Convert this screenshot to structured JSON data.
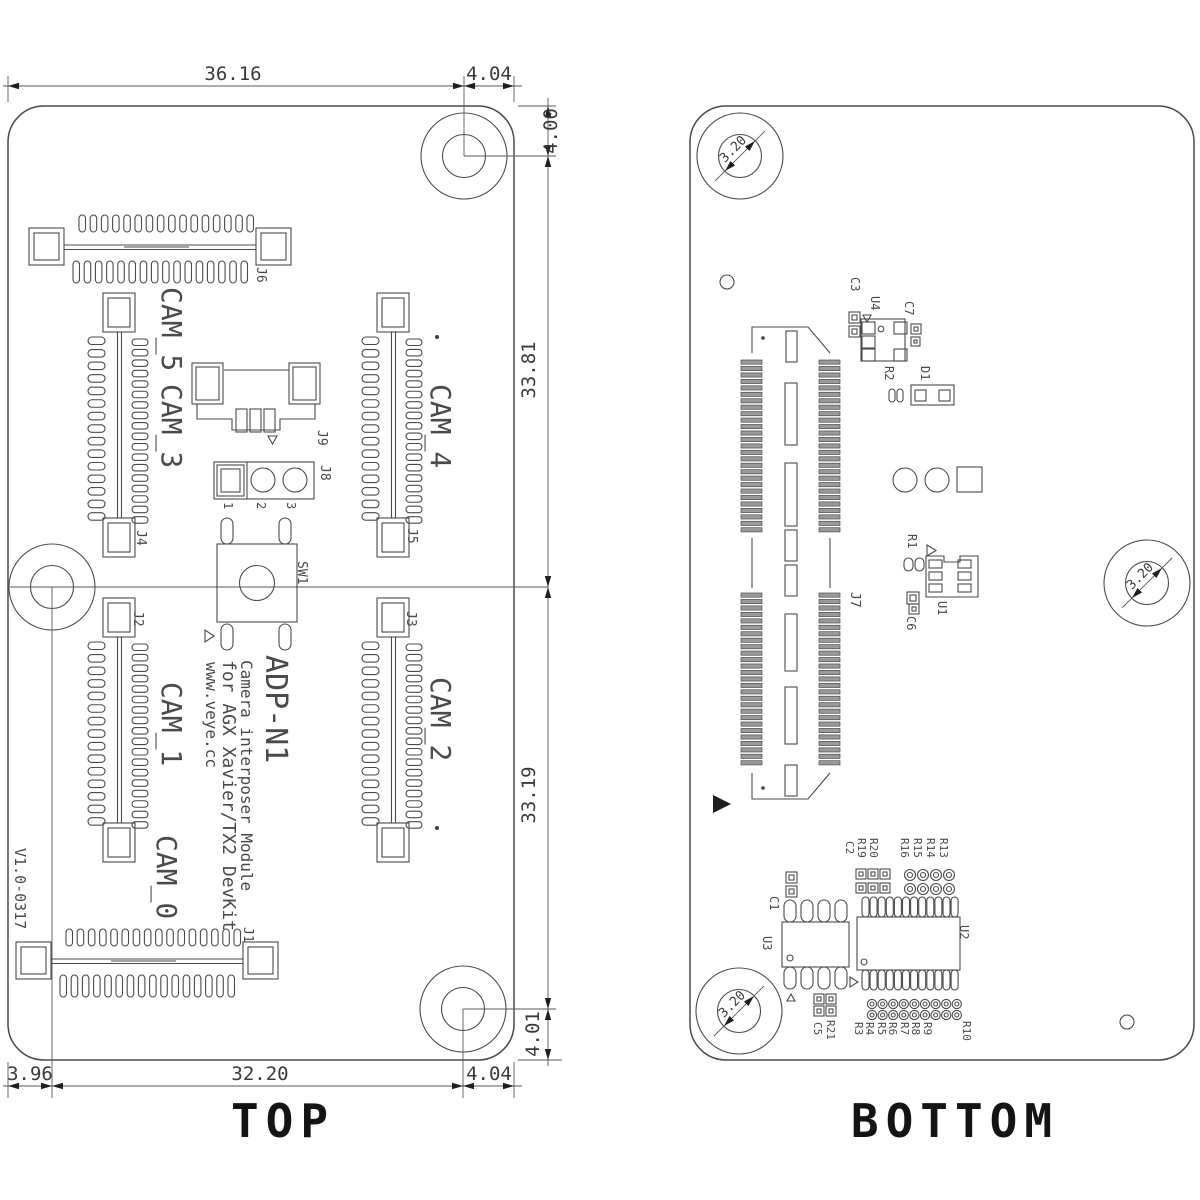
{
  "drawing": {
    "top_view": {
      "title": "TOP",
      "version": "V1.0-0317",
      "silkscreen": {
        "model": "ADP-N1",
        "line1": "Camera interposer Module",
        "line2": "for AGX Xavier/TX2 DevKit",
        "line3": "www.veye.cc"
      },
      "cams": {
        "cam0": "CAM_0",
        "cam1": "CAM_1",
        "cam2": "CAM_2",
        "cam3": "CAM_3",
        "cam4": "CAM_4",
        "cam5": "CAM_5"
      },
      "refs": {
        "j1": "J1",
        "j2": "J2",
        "j3": "J3",
        "j4": "J4",
        "j5": "J5",
        "j6": "J6",
        "j8": "J8",
        "j9": "J9",
        "sw1": "SW1"
      },
      "jumper_pins": [
        "1",
        "2",
        "3"
      ],
      "dims": {
        "top_main": "36.16",
        "top_offset": "4.04",
        "right_top": "4.00",
        "right_upper": "33.81",
        "right_lower": "33.19",
        "right_bottom": "4.01",
        "bottom_left": "3.96",
        "bottom_main": "32.20",
        "bottom_offset": "4.04"
      }
    },
    "bottom_view": {
      "title": "BOTTOM",
      "hole_diameter": "3.20",
      "refs": {
        "j7": "J7",
        "u1": "U1",
        "u2": "U2",
        "u3": "U3",
        "u4": "U4",
        "d1": "D1",
        "r1": "R1",
        "r2": "R2",
        "r10": "R10",
        "r19": "R19",
        "r20": "R20",
        "r21": "R21",
        "c1": "C1",
        "c2": "C2",
        "c3": "C3",
        "c5": "C5",
        "c6": "C6",
        "c7": "C7"
      },
      "r_row_upper": [
        "R16",
        "R15",
        "R14",
        "R13"
      ],
      "r_row_lower": [
        "R3",
        "R4",
        "R5",
        "R6",
        "R7",
        "R8",
        "R9"
      ]
    }
  },
  "colors": {
    "line": "#4a4a4a",
    "text": "#3f3f3f",
    "label": "#141414",
    "background": "#ffffff"
  }
}
